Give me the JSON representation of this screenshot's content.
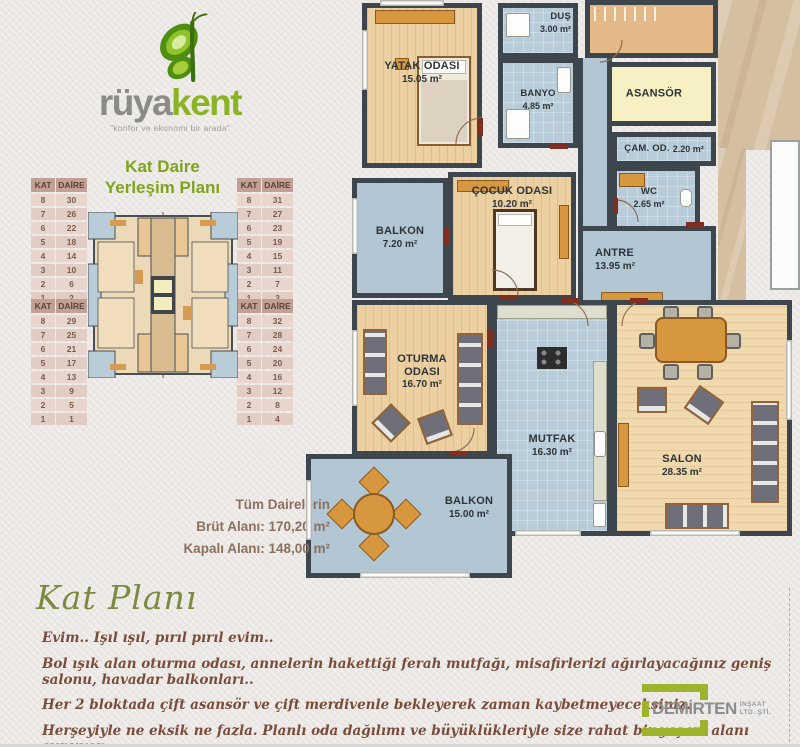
{
  "brand": {
    "name_gray": "rüya",
    "name_green": "kent",
    "tagline": "\"konfor ve ekonomi bir arada\""
  },
  "title": {
    "line1": "Kat Daire",
    "line2": "Yerleşim Planı"
  },
  "tables": [
    {
      "headers": [
        "KAT",
        "DAİRE"
      ],
      "rows": [
        [
          8,
          30
        ],
        [
          7,
          26
        ],
        [
          6,
          22
        ],
        [
          5,
          18
        ],
        [
          4,
          14
        ],
        [
          3,
          10
        ],
        [
          2,
          6
        ],
        [
          1,
          2
        ]
      ]
    },
    {
      "headers": [
        "KAT",
        "DAİRE"
      ],
      "rows": [
        [
          8,
          31
        ],
        [
          7,
          27
        ],
        [
          6,
          23
        ],
        [
          5,
          19
        ],
        [
          4,
          15
        ],
        [
          3,
          11
        ],
        [
          2,
          7
        ],
        [
          1,
          3
        ]
      ]
    },
    {
      "headers": [
        "KAT",
        "DAİRE"
      ],
      "rows": [
        [
          8,
          29
        ],
        [
          7,
          25
        ],
        [
          6,
          21
        ],
        [
          5,
          17
        ],
        [
          4,
          13
        ],
        [
          3,
          9
        ],
        [
          2,
          5
        ],
        [
          1,
          1
        ]
      ]
    },
    {
      "headers": [
        "KAT",
        "DAİRE"
      ],
      "rows": [
        [
          8,
          32
        ],
        [
          7,
          28
        ],
        [
          6,
          24
        ],
        [
          5,
          20
        ],
        [
          4,
          16
        ],
        [
          3,
          12
        ],
        [
          2,
          8
        ],
        [
          1,
          4
        ]
      ]
    }
  ],
  "plan": {
    "rooms": [
      {
        "name": "YATAK ODASI",
        "area": "15.05 m²"
      },
      {
        "name": "DUŞ",
        "area": "3.00 m²"
      },
      {
        "name": "BANYO",
        "area": "4.85 m²"
      },
      {
        "name": "ASANSÖR",
        "area": ""
      },
      {
        "name": "ÇAM. OD.",
        "area": "2.20 m²"
      },
      {
        "name": "WC",
        "area": "2.65 m²"
      },
      {
        "name": "ÇOCUK ODASI",
        "area": "10.20 m²"
      },
      {
        "name": "BALKON",
        "area": "7.20 m²"
      },
      {
        "name": "ANTRE",
        "area": "13.95 m²"
      },
      {
        "name": "OTURMA ODASI",
        "area": "16.70 m²"
      },
      {
        "name": "MUTFAK",
        "area": "16.30 m²"
      },
      {
        "name": "SALON",
        "area": "28.35 m²"
      },
      {
        "name": "BALKON",
        "area": "15.00 m²"
      }
    ]
  },
  "summary": {
    "line1": "Tüm Dairelerin",
    "line2": "Brüt Alanı: 170,20 m²",
    "line3": "Kapalı Alanı: 148,00 m²"
  },
  "section": {
    "heading": "Kat Planı",
    "paragraphs": [
      "Evim.. Işıl ışıl, pırıl pırıl evim..",
      "Bol ışık alan oturma odası, annelerin hakettiği ferah mutfağı, misafirlerizi ağırlayacağınız geniş salonu, havadar balkonları..",
      "Her 2 bloktada çift asansör ve çift merdivenle bekleyerek zaman kaybetmeyeceksiniz.",
      "Herşeyiyle ne eksik ne fazla. Planlı oda dağılımı ve büyüklükleriyle size rahat bir yaşam alanı sunuyor."
    ]
  },
  "footer_logo": {
    "name": "DEMİRTEN",
    "sub1": "İNŞAAT",
    "sub2": "LTD. ŞTİ."
  },
  "colors": {
    "brand_green": "#8cb226",
    "brand_gray": "#8c8b88",
    "title_green": "#7ea31d",
    "wall": "#3c464c",
    "wood_floor": "#ecd0a2",
    "wet_floor": "#b7ccd8",
    "elevator_yellow": "#f6f0c2",
    "table_header_bg": "#c2a096",
    "text_brown": "#7b4c39",
    "summary_brown": "#8b7060",
    "script_olive": "#7b8a3e"
  }
}
